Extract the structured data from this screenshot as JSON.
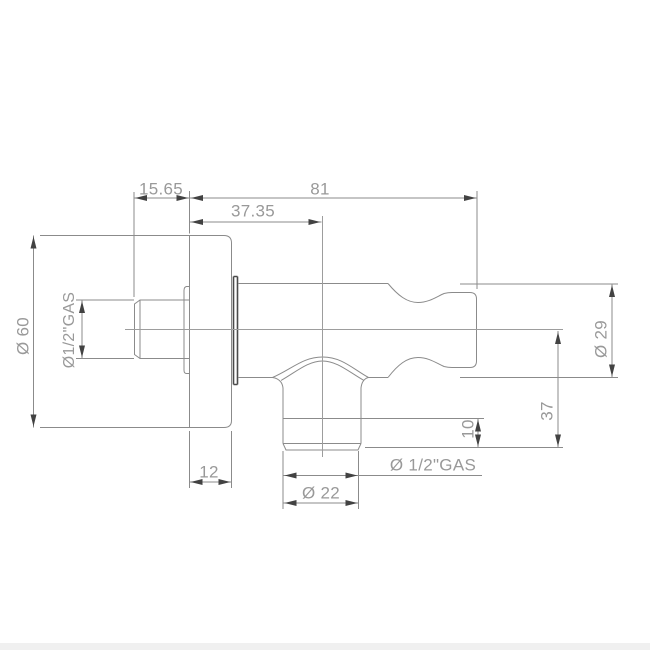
{
  "drawing_type": "technical dimension drawing",
  "colors": {
    "background": "#ffffff",
    "line": "#8b8b8b",
    "centerline": "#9d9d9d",
    "arrow": "#424242",
    "ring": "#4a4a4a",
    "text": "#999999",
    "bottom_band": "#f0f0f0"
  },
  "dims": {
    "wall_to_flange": "15.65",
    "overall_length": "81",
    "flange_to_outlet": "37.35",
    "flange_diameter": "Ø 60",
    "inlet_thread": "Ø1/2\"GAS",
    "body_diameter": "Ø 29",
    "center_to_outlet_end": "37",
    "outlet_thread_length": "10",
    "outlet_thread": "Ø 1/2\"GAS",
    "outlet_diameter": "Ø 22",
    "flange_thickness": "12"
  }
}
